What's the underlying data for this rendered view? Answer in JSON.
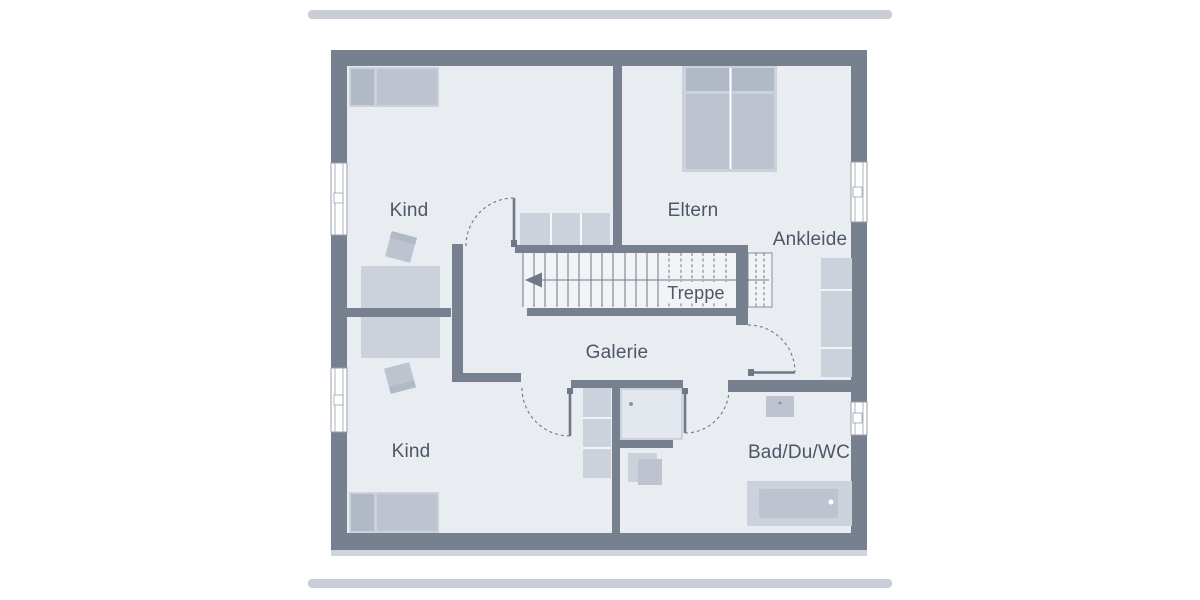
{
  "rooms": {
    "kind_top": {
      "label": "Kind"
    },
    "eltern": {
      "label": "Eltern"
    },
    "ankleide": {
      "label": "Ankleide"
    },
    "treppe": {
      "label": "Treppe"
    },
    "galerie": {
      "label": "Galerie"
    },
    "kind_bottom": {
      "label": "Kind"
    },
    "bad": {
      "label": "Bad/Du/WC"
    }
  },
  "colors": {
    "background": "#ffffff",
    "wall": "#77808f",
    "floor": "#e9ecf1",
    "stair_floor": "#f1f3f6",
    "furniture_light": "#ccd2db",
    "furniture_mid": "#bdc3cf",
    "furniture_dark": "#b2b9c6",
    "line": "#6e7887",
    "window_frame": "#99a1ae",
    "text": "#4c5768",
    "bar": "#c9cdd5",
    "shadow": "#d0d5dc"
  }
}
